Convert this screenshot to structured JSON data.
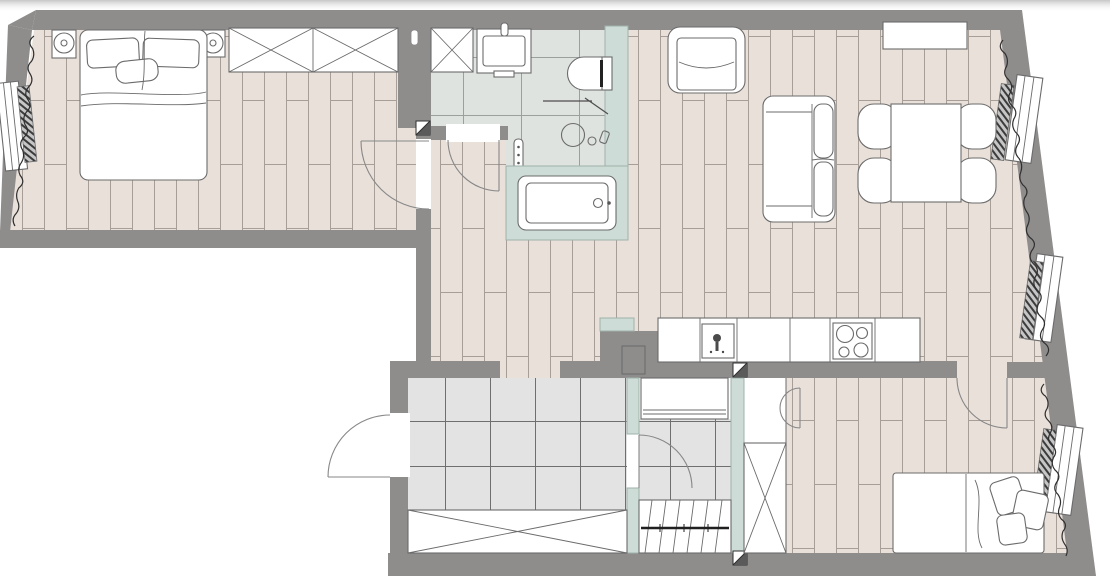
{
  "meta": {
    "title": "Apartment floor plan, top-down architectural drawing",
    "view": "top-down",
    "text_labels": []
  },
  "colors": {
    "wall": "#8f8c8c",
    "teal": "#cddcd6",
    "tealline": "#9fb2ab",
    "wood": "#e9e0da",
    "woodline": "#a89e98",
    "bathtile": "#dfe3e0",
    "bathtileline": "#9aa09c",
    "halltile": "#e3e3e3",
    "halltileline": "#6f6f6f",
    "line": "#6b6b6b",
    "curtain": "#2f2f2f"
  },
  "rooms": [
    {
      "id": "bedroom-1",
      "position": "top-left",
      "floor": "wood-plank",
      "items": [
        "double-bed",
        "pillows-x3",
        "nightstand-with-lamp-left",
        "nightstand-with-lamp-right",
        "crossed-wardrobe",
        "window",
        "radiator",
        "curtain",
        "door-swing"
      ]
    },
    {
      "id": "bathroom",
      "position": "top-center",
      "floor": "ceramic-tile",
      "items": [
        "washing-machine-crossed",
        "washbasin",
        "toilet",
        "shower-set",
        "towel-radiator",
        "bathtub-on-teal-platform",
        "door-swing",
        "teal-wall"
      ]
    },
    {
      "id": "corridor",
      "position": "center",
      "floor": "wood-plank",
      "items": []
    },
    {
      "id": "living-room-kitchen",
      "position": "right",
      "floor": "wood-plank",
      "items": [
        "armchair",
        "sideboard",
        "sofa",
        "dining-table",
        "dining-chairs-x4",
        "kitchen-counter",
        "kitchen-sink",
        "cooktop-4-burners",
        "service-shaft",
        "window-x2",
        "radiator-x2",
        "curtain",
        "door-to-bedroom-2"
      ]
    },
    {
      "id": "entrance-hall",
      "position": "bottom-left",
      "floor": "ceramic-tile",
      "items": [
        "entrance-door",
        "crossed-built-in-closet",
        "opening-to-corridor",
        "teal-partition"
      ]
    },
    {
      "id": "stair-room",
      "position": "bottom-center",
      "floor": "ceramic-tile",
      "items": [
        "coat-closet",
        "staircase-down-with-section-line",
        "door-swing"
      ]
    },
    {
      "id": "bedroom-2",
      "position": "bottom-right",
      "floor": "wood-plank",
      "items": [
        "single-bed",
        "pillows-x3",
        "crossed-wardrobe",
        "semicircle-door",
        "window",
        "radiator",
        "curtain",
        "door-swing"
      ]
    }
  ],
  "symbols": [
    "hatched-radiator-bars",
    "wavy-curtain-lines",
    "diagonal-square-wall-markers",
    "door-swing-arcs",
    "cross-boxes-for-storage"
  ]
}
